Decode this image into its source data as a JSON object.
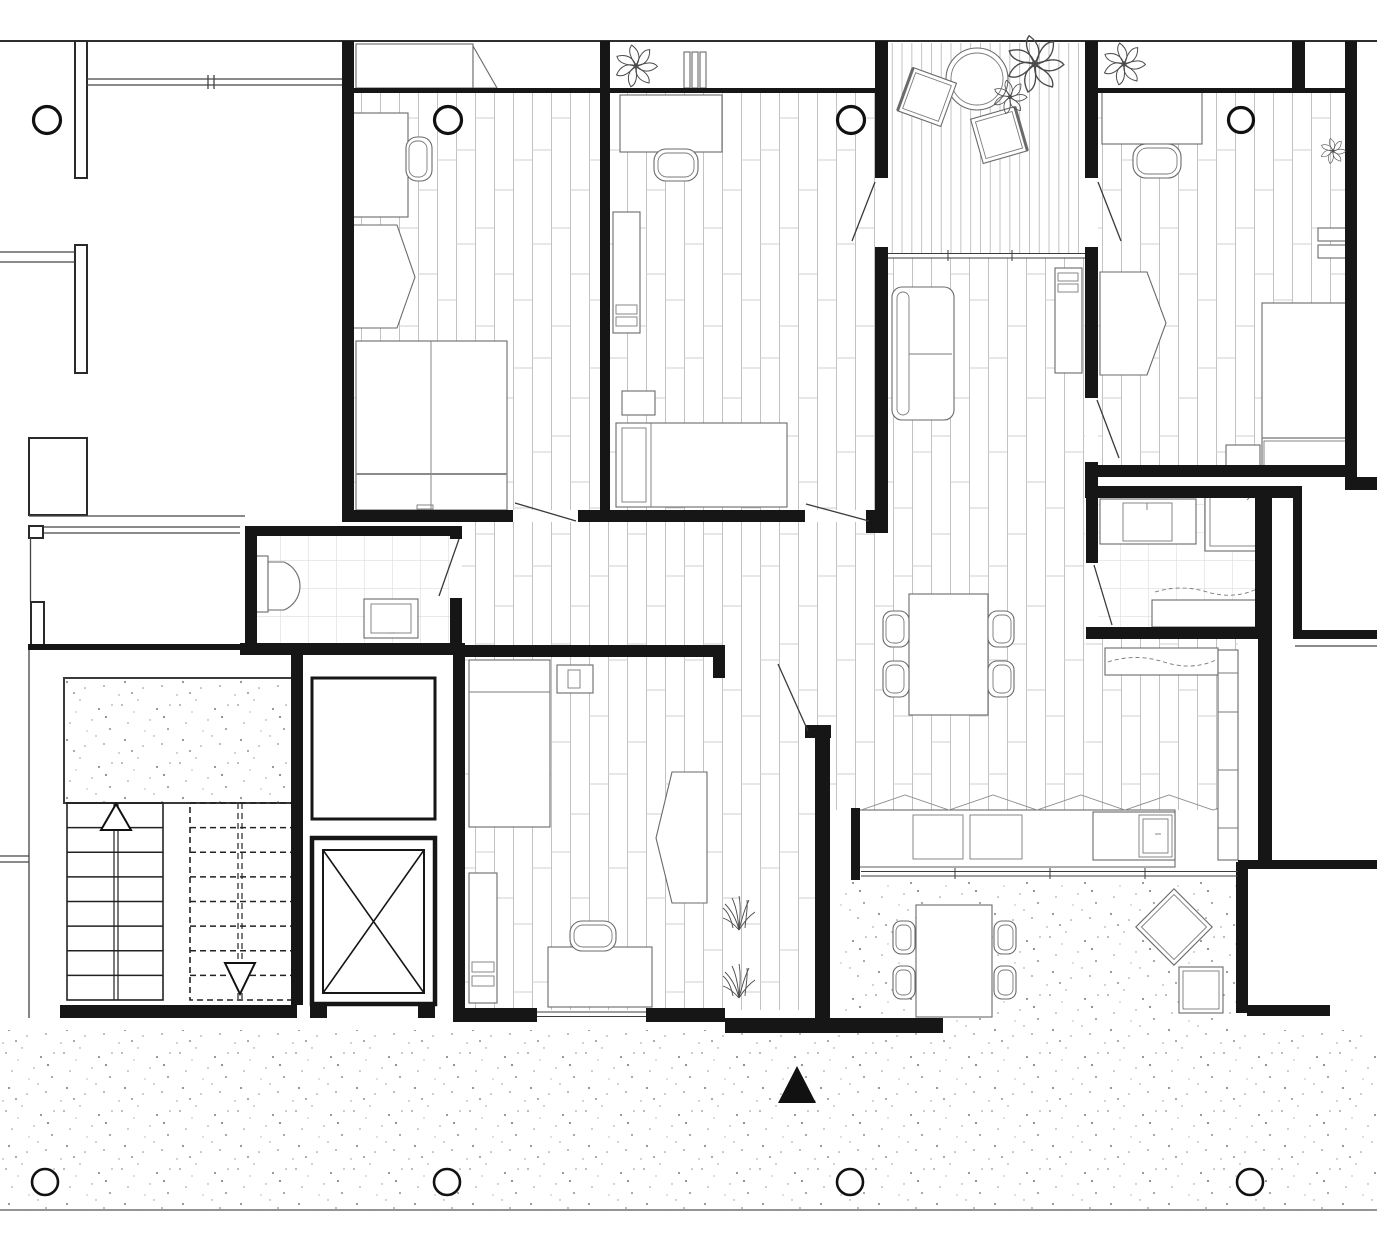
{
  "meta": {
    "kind": "architectural-floor-plan",
    "canvas": {
      "width": 1377,
      "height": 1242
    },
    "textual_labels_present": false
  },
  "palette": {
    "background": "#ffffff",
    "wall": "#161616",
    "furniture_line": "#6a6a6a",
    "wood_line": "#c2c2c2",
    "wood_joint": "#cfcfcf",
    "deck_line": "#b8b8b8",
    "tile_line": "#d6d6d6",
    "stipple_dot": "#8f8f8f",
    "north_arrow_fill": "#111111"
  },
  "floors": {
    "wood": [
      {
        "x": 354,
        "y": 90,
        "w": 246,
        "h": 420,
        "name": "bedroom-1-floor"
      },
      {
        "x": 610,
        "y": 90,
        "w": 266,
        "h": 420,
        "name": "bedroom-2-floor"
      },
      {
        "x": 1098,
        "y": 90,
        "w": 247,
        "h": 375,
        "name": "bedroom-3-floor"
      },
      {
        "x": 465,
        "y": 657,
        "w": 350,
        "h": 353,
        "name": "bedroom-4-floor"
      },
      {
        "x": 462,
        "y": 522,
        "w": 414,
        "h": 123,
        "name": "hallway-floor"
      },
      {
        "x": 888,
        "y": 258,
        "w": 197,
        "h": 552,
        "name": "living-room-floor"
      },
      {
        "x": 815,
        "y": 533,
        "w": 73,
        "h": 277,
        "name": "living-room-floor-west"
      },
      {
        "x": 725,
        "y": 645,
        "w": 90,
        "h": 12,
        "name": "doorway-strip-floor"
      },
      {
        "x": 1086,
        "y": 639,
        "w": 152,
        "h": 171,
        "name": "kitchen-nook-floor"
      }
    ],
    "deck": [
      {
        "x": 888,
        "y": 43,
        "w": 197,
        "h": 210,
        "name": "balcony-deck"
      }
    ],
    "tile": [
      {
        "x": 257,
        "y": 536,
        "w": 193,
        "h": 107,
        "name": "bathroom-1-tiles"
      },
      {
        "x": 1098,
        "y": 498,
        "w": 157,
        "h": 129,
        "name": "bathroom-2-tiles"
      }
    ],
    "stipple": [
      {
        "x": 64,
        "y": 678,
        "w": 229,
        "h": 125,
        "name": "stair-landing"
      },
      {
        "x": 840,
        "y": 880,
        "w": 398,
        "h": 150,
        "name": "terrace-patio"
      },
      {
        "x": 0,
        "y": 1030,
        "w": 1377,
        "h": 180,
        "name": "ground-band"
      }
    ]
  },
  "structure": {
    "columns": [
      {
        "x": 47,
        "y": 120,
        "r": 13.5,
        "sw": 3.2,
        "name": "column-top-1"
      },
      {
        "x": 448,
        "y": 120,
        "r": 13.5,
        "sw": 3.2,
        "name": "column-top-2"
      },
      {
        "x": 851,
        "y": 120,
        "r": 13.5,
        "sw": 3.2,
        "name": "column-top-3"
      },
      {
        "x": 1241,
        "y": 120,
        "r": 12.5,
        "sw": 3.2,
        "name": "column-top-4"
      },
      {
        "x": 45,
        "y": 1182,
        "r": 13,
        "sw": 2.6,
        "name": "column-bottom-1"
      },
      {
        "x": 447,
        "y": 1182,
        "r": 13,
        "sw": 2.6,
        "name": "column-bottom-2"
      },
      {
        "x": 850,
        "y": 1182,
        "r": 13,
        "sw": 2.6,
        "name": "column-bottom-3"
      },
      {
        "x": 1250,
        "y": 1182,
        "r": 13,
        "sw": 2.6,
        "name": "column-bottom-4"
      }
    ]
  },
  "stairs": {
    "left_flight": {
      "x": 67,
      "y": 803,
      "w": 96,
      "h": 197,
      "treads": 8,
      "style": "solid",
      "arrow": "up",
      "rail_x": [
        114,
        118
      ]
    },
    "right_flight": {
      "x": 190,
      "y": 803,
      "w": 103,
      "h": 197,
      "treads": 8,
      "style": "dashed",
      "arrow": "down",
      "rail_x": [
        238,
        242
      ]
    },
    "landing": {
      "x": 64,
      "y": 678,
      "w": 229,
      "h": 125
    }
  },
  "symbols": {
    "north_arrow": {
      "points": "797,1066 778,1103 816,1103",
      "fill": "#111111"
    }
  },
  "decor": {
    "plants": [
      {
        "x": 1035,
        "y": 64,
        "s": 1.35,
        "name": "balcony-plant-large"
      },
      {
        "x": 1010,
        "y": 97,
        "s": 0.8,
        "name": "balcony-plant-small"
      },
      {
        "x": 636,
        "y": 66,
        "s": 1.0,
        "name": "bedroom-2-shelf-plant"
      },
      {
        "x": 1124,
        "y": 64,
        "s": 1.0,
        "name": "bedroom-3-shelf-plant"
      },
      {
        "x": 1333,
        "y": 151,
        "s": 0.6,
        "name": "bedroom-3-wall-plant"
      }
    ],
    "grass": [
      {
        "x": 739,
        "y": 930,
        "name": "indoor-grass-plant-1"
      },
      {
        "x": 739,
        "y": 998,
        "name": "indoor-grass-plant-2"
      }
    ]
  }
}
